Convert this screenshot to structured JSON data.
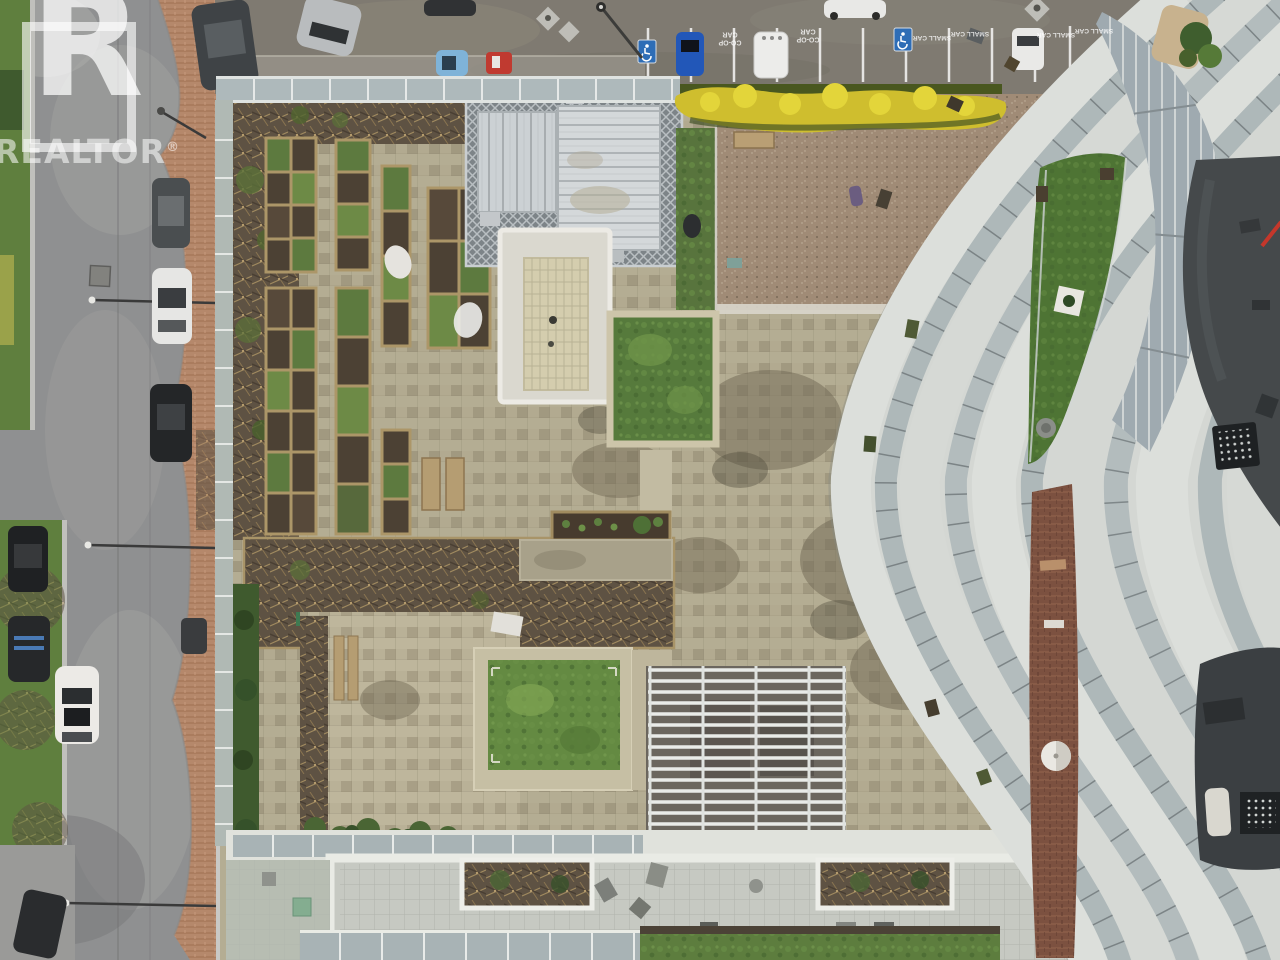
{
  "watermark": {
    "logo_letter": "R",
    "brand": "REALTOR",
    "reg": "®"
  },
  "parking": {
    "coop_stall_label": "CO-OP CAR",
    "small_stall_label": "SMALL CAR",
    "accessible_icon": "wheelchair-symbol",
    "accessible_stall_count": 2
  },
  "scene": {
    "type": "aerial-drone-photo",
    "subject": "rooftop courtyard with community garden beds, street with parked cars, curved glass balcony tower"
  },
  "palette": {
    "road_asphalt": "#8f9091",
    "parking_asphalt": "#7f7a71",
    "sidewalk_brick": "#b5886b",
    "grass_verge": "#5f7f3e",
    "forsythia_yellow": "#d3c22f",
    "paver_tan": "#b4ad93",
    "moss_brown": "#6f6753",
    "soil_dark": "#4c4134",
    "plant_green": "#5d7a3f",
    "planter_wood": "#ac9668",
    "penthouse_roof": "#d4d8da",
    "skylight_beige": "#d4cdae",
    "lawn_green": "#648a42",
    "gravel_tan": "#a08b76",
    "tower_concrete": "#d9dcd8",
    "tower_glass": "#aeb8b9",
    "tower_dark_roof": "#45494b",
    "brick_wall": "#7c5140",
    "balcony_turf": "#4e7434",
    "stall_paint": "#ffffff",
    "accessible_blue": "#2e6db6"
  }
}
